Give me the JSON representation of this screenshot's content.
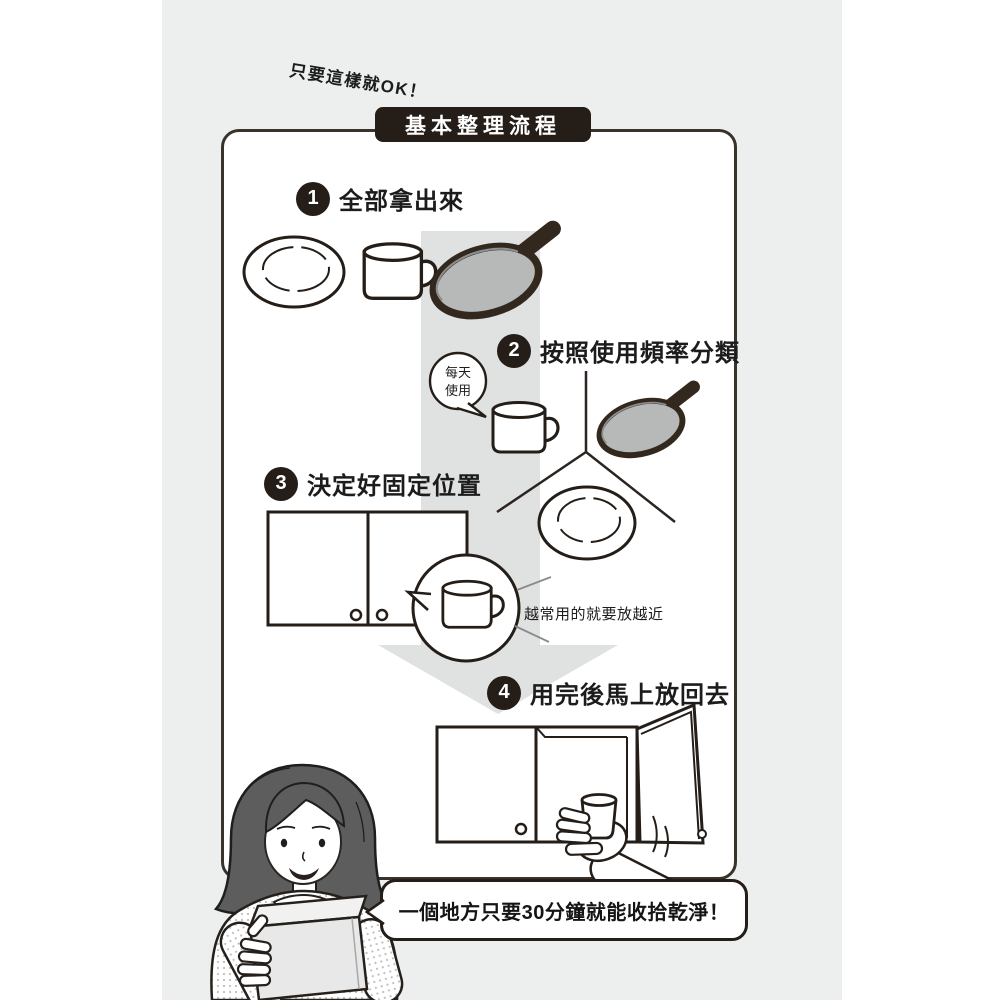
{
  "tagline": "只要這樣就OK！",
  "title": "基本整理流程",
  "steps": [
    {
      "num": "1",
      "label": "全部拿出來"
    },
    {
      "num": "2",
      "label": "按照使用頻率分類"
    },
    {
      "num": "3",
      "label": "決定好固定位置"
    },
    {
      "num": "4",
      "label": "用完後馬上放回去"
    }
  ],
  "daily_bubble": {
    "line1": "每天",
    "line2": "使用"
  },
  "placement_note": "越常用的就要放越近",
  "bottom_bubble": "一個地方只要30分鐘就能收拾乾淨！",
  "colors": {
    "ink": "#251d17",
    "page_bg": "#edefee",
    "arrow_gray": "#e0e1e1",
    "pan_gray": "#b7b8b8",
    "hair_gray": "#5d5d5d",
    "box_gray": "#e8e8e8"
  }
}
